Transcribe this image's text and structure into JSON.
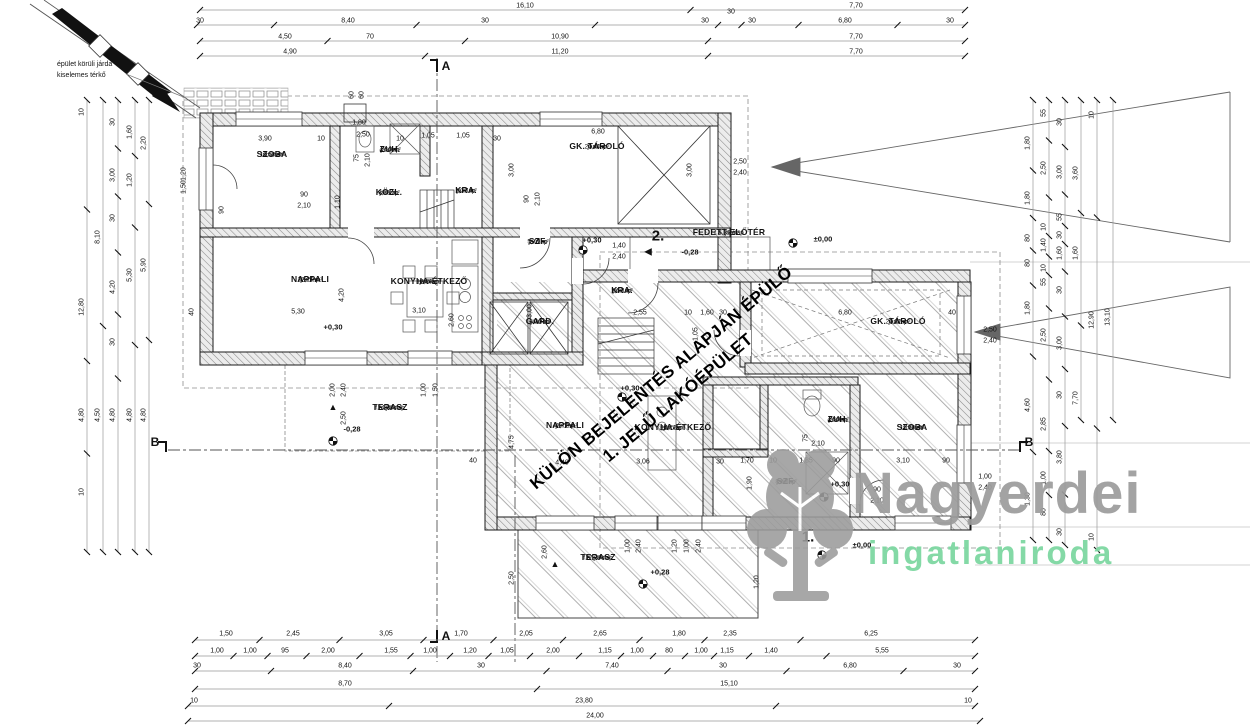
{
  "notes": {
    "line1": "épület körüli járda",
    "line2": "kiselemes térkő"
  },
  "watermark": {
    "line1": "KÜLÖN BEJELENTÉS ALAPJÁN ÉPÜLŐ",
    "line2": "1. JELŰ LAKÓÉPÜLET"
  },
  "logo": {
    "name": "Nagyerdei",
    "subtitle": "ingatlaniroda",
    "name_color": "#9c9c9c",
    "subtitle_color": "#7ed8a2",
    "tree_icon": "oak-tree-icon"
  },
  "colors": {
    "line": "#1a1a1a",
    "dim_text": "#111111",
    "hatch": "#9a9a9a",
    "chain_line": "#999999"
  },
  "section_marks": [
    {
      "t": "A",
      "x": 446,
      "y": 66
    },
    {
      "t": "A",
      "x": 446,
      "y": 636
    },
    {
      "t": "B",
      "x": 155,
      "y": 442
    },
    {
      "t": "B",
      "x": 1029,
      "y": 442
    }
  ],
  "building2": {
    "number": "2.",
    "nx": 658,
    "ny": 236,
    "rooms": [
      {
        "name": "SZOBA",
        "finish": "laminált",
        "area": "10,50 m²",
        "x": 272,
        "y": 155
      },
      {
        "name": "ZUH.",
        "finish": "járólap",
        "area": "4,50 m²",
        "x": 390,
        "y": 150
      },
      {
        "name": "KÖZL.",
        "finish": "járólap",
        "area": "3,88 m²",
        "x": 389,
        "y": 193
      },
      {
        "name": "KRA.",
        "finish": "járólap",
        "area": "1,37 m²",
        "x": 466,
        "y": 191
      },
      {
        "name": "GK. TÁROLÓ",
        "finish": "járólap",
        "area": "20,40 m²",
        "x": 597,
        "y": 147
      },
      {
        "name": "SZF.",
        "finish": "járólap",
        "area": "5,70 m²",
        "x": 538,
        "y": 242
      },
      {
        "name": "NAPPALI",
        "finish": "járólap",
        "area": "22,26 m²",
        "x": 310,
        "y": 280
      },
      {
        "name": "KONYHA-ÉTKEZŐ",
        "finish": "járólap",
        "area": "18,39 m²",
        "x": 429,
        "y": 282
      },
      {
        "name": "GARD.",
        "finish": "járólap",
        "area": "6,30 m²",
        "x": 540,
        "y": 322
      },
      {
        "name": "TERASZ",
        "finish": "f.á. járólap",
        "area": "14,88 m²",
        "x": 390,
        "y": 408
      },
      {
        "name": "FEDETT ELŐTÉR",
        "finish": "f.á. járólap",
        "area": "5,32 m²",
        "x": 729,
        "y": 233
      }
    ]
  },
  "building1": {
    "number": "1.",
    "nx": 808,
    "ny": 537,
    "rooms": [
      {
        "name": "KRA.",
        "finish": "járólap",
        "area": "2,52 m²",
        "x": 622,
        "y": 291
      },
      {
        "name": "GK. TÁROLÓ",
        "finish": "járólap",
        "area": "20,22 m²",
        "x": 898,
        "y": 322
      },
      {
        "name": "NAPPALI",
        "finish": "járólap",
        "area": "41,72 m²",
        "x": 565,
        "y": 426
      },
      {
        "name": "KONYHA-ÉTKEZŐ",
        "finish": "járólap",
        "area": "14,12 m²",
        "x": 673,
        "y": 428
      },
      {
        "name": "ZUH.",
        "finish": "járólap",
        "area": "4,50 m²",
        "x": 838,
        "y": 420
      },
      {
        "name": "SZOBA",
        "finish": "laminált",
        "area": "11,76 m²",
        "x": 912,
        "y": 428
      },
      {
        "name": "SZF.",
        "finish": "járólap",
        "area": "8,67 m²",
        "x": 786,
        "y": 482
      },
      {
        "name": "TERASZ",
        "finish": "f.á. járólap",
        "area": "17,39 m²",
        "x": 598,
        "y": 558
      }
    ]
  },
  "level_marks": [
    {
      "t": "±0,00",
      "x": 823,
      "y": 239
    },
    {
      "t": "+0,30",
      "x": 592,
      "y": 240
    },
    {
      "t": "-0,28",
      "x": 690,
      "y": 252
    },
    {
      "t": "+0,30",
      "x": 333,
      "y": 327
    },
    {
      "t": "-0,28",
      "x": 352,
      "y": 429
    },
    {
      "t": "+0,30",
      "x": 630,
      "y": 388
    },
    {
      "t": "+0,30",
      "x": 840,
      "y": 484
    },
    {
      "t": "+0,28",
      "x": 660,
      "y": 572
    },
    {
      "t": "±0,00",
      "x": 862,
      "y": 545
    }
  ],
  "benchmarks": [
    [
      583,
      250
    ],
    [
      793,
      243
    ],
    [
      333,
      441
    ],
    [
      622,
      397
    ],
    [
      824,
      497
    ],
    [
      643,
      584
    ],
    [
      822,
      555
    ]
  ],
  "markers": {
    "down_triangles": [
      [
        333,
        407
      ],
      [
        555,
        564
      ]
    ],
    "left_arrows": [
      [
        648,
        252
      ]
    ]
  },
  "dim_labels": [
    {
      "t": "16,10",
      "x": 525,
      "y": 6,
      "c": "t1"
    },
    {
      "t": "7,70",
      "x": 856,
      "y": 6,
      "c": "t1"
    },
    {
      "t": "30",
      "x": 200,
      "y": 21,
      "c": "t2"
    },
    {
      "t": "8,40",
      "x": 348,
      "y": 21,
      "c": "t2"
    },
    {
      "t": "30",
      "x": 485,
      "y": 21,
      "c": "t2"
    },
    {
      "t": "30",
      "x": 705,
      "y": 21,
      "c": "t2"
    },
    {
      "t": "30",
      "x": 731,
      "y": 12,
      "c": "t2"
    },
    {
      "t": "30",
      "x": 752,
      "y": 21,
      "c": "t2"
    },
    {
      "t": "6,80",
      "x": 845,
      "y": 21,
      "c": "t2"
    },
    {
      "t": "30",
      "x": 950,
      "y": 21,
      "c": "t2"
    },
    {
      "t": "4,50",
      "x": 285,
      "y": 37,
      "c": "t3"
    },
    {
      "t": "70",
      "x": 370,
      "y": 37,
      "c": "t3"
    },
    {
      "t": "10,90",
      "x": 560,
      "y": 37,
      "c": "t3"
    },
    {
      "t": "7,70",
      "x": 856,
      "y": 37,
      "c": "t3"
    },
    {
      "t": "4,90",
      "x": 290,
      "y": 52,
      "c": "t4"
    },
    {
      "t": "11,20",
      "x": 560,
      "y": 52,
      "c": "t4"
    },
    {
      "t": "7,70",
      "x": 856,
      "y": 52,
      "c": "t4"
    },
    {
      "t": "1,50",
      "x": 226,
      "y": 634,
      "c": "b1"
    },
    {
      "t": "2,45",
      "x": 293,
      "y": 634,
      "c": "b1"
    },
    {
      "t": "3,05",
      "x": 386,
      "y": 634,
      "c": "b1"
    },
    {
      "t": "1,70",
      "x": 461,
      "y": 634,
      "c": "b1"
    },
    {
      "t": "2,05",
      "x": 526,
      "y": 634,
      "c": "b1"
    },
    {
      "t": "2,65",
      "x": 600,
      "y": 634,
      "c": "b1"
    },
    {
      "t": "1,80",
      "x": 679,
      "y": 634,
      "c": "b1"
    },
    {
      "t": "2,35",
      "x": 730,
      "y": 634,
      "c": "b1"
    },
    {
      "t": "6,25",
      "x": 871,
      "y": 634,
      "c": "b1"
    },
    {
      "t": "1,00",
      "x": 217,
      "y": 651,
      "c": "b2"
    },
    {
      "t": "1,00",
      "x": 250,
      "y": 651,
      "c": "b2"
    },
    {
      "t": "95",
      "x": 285,
      "y": 651,
      "c": "b2"
    },
    {
      "t": "2,00",
      "x": 328,
      "y": 651,
      "c": "b2"
    },
    {
      "t": "1,55",
      "x": 391,
      "y": 651,
      "c": "b2"
    },
    {
      "t": "1,00",
      "x": 430,
      "y": 651,
      "c": "b2"
    },
    {
      "t": "1,20",
      "x": 470,
      "y": 651,
      "c": "b2"
    },
    {
      "t": "1,05",
      "x": 507,
      "y": 651,
      "c": "b2"
    },
    {
      "t": "2,00",
      "x": 553,
      "y": 651,
      "c": "b2"
    },
    {
      "t": "1,15",
      "x": 605,
      "y": 651,
      "c": "b2"
    },
    {
      "t": "1,00",
      "x": 637,
      "y": 651,
      "c": "b2"
    },
    {
      "t": "80",
      "x": 669,
      "y": 651,
      "c": "b2"
    },
    {
      "t": "1,00",
      "x": 701,
      "y": 651,
      "c": "b2"
    },
    {
      "t": "1,15",
      "x": 727,
      "y": 651,
      "c": "b2"
    },
    {
      "t": "1,40",
      "x": 771,
      "y": 651,
      "c": "b2"
    },
    {
      "t": "5,55",
      "x": 882,
      "y": 651,
      "c": "b2"
    },
    {
      "t": "30",
      "x": 197,
      "y": 666,
      "c": "b3"
    },
    {
      "t": "8,40",
      "x": 345,
      "y": 666,
      "c": "b3"
    },
    {
      "t": "30",
      "x": 481,
      "y": 666,
      "c": "b3"
    },
    {
      "t": "7,40",
      "x": 612,
      "y": 666,
      "c": "b3"
    },
    {
      "t": "30",
      "x": 723,
      "y": 666,
      "c": "b3"
    },
    {
      "t": "6,80",
      "x": 850,
      "y": 666,
      "c": "b3"
    },
    {
      "t": "30",
      "x": 957,
      "y": 666,
      "c": "b3"
    },
    {
      "t": "8,70",
      "x": 345,
      "y": 684,
      "c": "b4"
    },
    {
      "t": "15,10",
      "x": 729,
      "y": 684,
      "c": "b4"
    },
    {
      "t": "10",
      "x": 194,
      "y": 701,
      "c": "b5"
    },
    {
      "t": "23,80",
      "x": 584,
      "y": 701,
      "c": "b5"
    },
    {
      "t": "10",
      "x": 968,
      "y": 701,
      "c": "b5"
    },
    {
      "t": "24,00",
      "x": 595,
      "y": 716,
      "c": "b6"
    },
    {
      "t": "10",
      "x": 82,
      "y": 112,
      "r": 1,
      "c": "l1"
    },
    {
      "t": "12,80",
      "x": 82,
      "y": 307,
      "r": 1,
      "c": "l1"
    },
    {
      "t": "4,80",
      "x": 82,
      "y": 415,
      "r": 1,
      "c": "l1"
    },
    {
      "t": "10",
      "x": 82,
      "y": 492,
      "r": 1,
      "c": "l1"
    },
    {
      "t": "8,10",
      "x": 98,
      "y": 237,
      "r": 1,
      "c": "l2"
    },
    {
      "t": "4,50",
      "x": 98,
      "y": 415,
      "r": 1,
      "c": "l2"
    },
    {
      "t": "30",
      "x": 113,
      "y": 122,
      "r": 1,
      "c": "l3"
    },
    {
      "t": "3,00",
      "x": 113,
      "y": 175,
      "r": 1,
      "c": "l3"
    },
    {
      "t": "30",
      "x": 113,
      "y": 218,
      "r": 1,
      "c": "l3"
    },
    {
      "t": "4,20",
      "x": 113,
      "y": 287,
      "r": 1,
      "c": "l3"
    },
    {
      "t": "30",
      "x": 113,
      "y": 342,
      "r": 1,
      "c": "l3"
    },
    {
      "t": "4,80",
      "x": 113,
      "y": 415,
      "r": 1,
      "c": "l3"
    },
    {
      "t": "1,60",
      "x": 130,
      "y": 132,
      "r": 1,
      "c": "l4"
    },
    {
      "t": "1,20",
      "x": 130,
      "y": 180,
      "r": 1,
      "c": "l4"
    },
    {
      "t": "5,30",
      "x": 130,
      "y": 275,
      "r": 1,
      "c": "l4"
    },
    {
      "t": "4,80",
      "x": 130,
      "y": 415,
      "r": 1,
      "c": "l4"
    },
    {
      "t": "2,20",
      "x": 144,
      "y": 143,
      "r": 1,
      "c": "l5"
    },
    {
      "t": "5,90",
      "x": 144,
      "y": 265,
      "r": 1,
      "c": "l5"
    },
    {
      "t": "4,80",
      "x": 144,
      "y": 415,
      "r": 1,
      "c": "l5"
    },
    {
      "t": "1,80",
      "x": 1028,
      "y": 143,
      "r": 1,
      "c": "r1"
    },
    {
      "t": "1,80",
      "x": 1028,
      "y": 198,
      "r": 1,
      "c": "r1"
    },
    {
      "t": "80",
      "x": 1028,
      "y": 238,
      "r": 1,
      "c": "r1"
    },
    {
      "t": "80",
      "x": 1028,
      "y": 263,
      "r": 1,
      "c": "r1"
    },
    {
      "t": "1,80",
      "x": 1028,
      "y": 308,
      "r": 1,
      "c": "r1"
    },
    {
      "t": "4,60",
      "x": 1028,
      "y": 405,
      "r": 1,
      "c": "r1"
    },
    {
      "t": "1,30",
      "x": 1028,
      "y": 499,
      "r": 1,
      "c": "r1"
    },
    {
      "t": "55",
      "x": 1044,
      "y": 113,
      "r": 1,
      "c": "r2"
    },
    {
      "t": "2,50",
      "x": 1044,
      "y": 168,
      "r": 1,
      "c": "r2"
    },
    {
      "t": "10",
      "x": 1044,
      "y": 227,
      "r": 1,
      "c": "r2"
    },
    {
      "t": "1,40",
      "x": 1044,
      "y": 245,
      "r": 1,
      "c": "r2"
    },
    {
      "t": "10",
      "x": 1044,
      "y": 268,
      "r": 1,
      "c": "r2"
    },
    {
      "t": "55",
      "x": 1044,
      "y": 282,
      "r": 1,
      "c": "r2"
    },
    {
      "t": "2,50",
      "x": 1044,
      "y": 335,
      "r": 1,
      "c": "r2"
    },
    {
      "t": "2,85",
      "x": 1044,
      "y": 424,
      "r": 1,
      "c": "r2"
    },
    {
      "t": "1,00",
      "x": 1044,
      "y": 478,
      "r": 1,
      "c": "r2"
    },
    {
      "t": "80",
      "x": 1044,
      "y": 512,
      "r": 1,
      "c": "r2"
    },
    {
      "t": "30",
      "x": 1060,
      "y": 122,
      "r": 1,
      "c": "r3"
    },
    {
      "t": "3,00",
      "x": 1060,
      "y": 172,
      "r": 1,
      "c": "r3"
    },
    {
      "t": "55",
      "x": 1060,
      "y": 217,
      "r": 1,
      "c": "r3"
    },
    {
      "t": "30",
      "x": 1060,
      "y": 235,
      "r": 1,
      "c": "r3"
    },
    {
      "t": "1,60",
      "x": 1060,
      "y": 253,
      "r": 1,
      "c": "r3"
    },
    {
      "t": "30",
      "x": 1060,
      "y": 290,
      "r": 1,
      "c": "r3"
    },
    {
      "t": "3,00",
      "x": 1060,
      "y": 343,
      "r": 1,
      "c": "r3"
    },
    {
      "t": "30",
      "x": 1060,
      "y": 395,
      "r": 1,
      "c": "r3"
    },
    {
      "t": "3,80",
      "x": 1060,
      "y": 457,
      "r": 1,
      "c": "r3"
    },
    {
      "t": "30",
      "x": 1060,
      "y": 532,
      "r": 1,
      "c": "r3"
    },
    {
      "t": "3,60",
      "x": 1076,
      "y": 173,
      "r": 1,
      "c": "r4"
    },
    {
      "t": "1,60",
      "x": 1076,
      "y": 253,
      "r": 1,
      "c": "r4"
    },
    {
      "t": "7,70",
      "x": 1076,
      "y": 398,
      "r": 1,
      "c": "r4"
    },
    {
      "t": "10",
      "x": 1092,
      "y": 115,
      "r": 1,
      "c": "r5"
    },
    {
      "t": "12,90",
      "x": 1092,
      "y": 320,
      "r": 1,
      "c": "r5"
    },
    {
      "t": "10",
      "x": 1092,
      "y": 537,
      "r": 1,
      "c": "r5"
    },
    {
      "t": "13,10",
      "x": 1108,
      "y": 317,
      "r": 1,
      "c": "r6"
    },
    {
      "t": "3,90",
      "x": 265,
      "y": 139
    },
    {
      "t": "10",
      "x": 321,
      "y": 139
    },
    {
      "t": "2,50",
      "x": 363,
      "y": 135
    },
    {
      "t": "10",
      "x": 400,
      "y": 139
    },
    {
      "t": "1,05",
      "x": 428,
      "y": 136
    },
    {
      "t": "1,05",
      "x": 463,
      "y": 136
    },
    {
      "t": "30",
      "x": 497,
      "y": 139
    },
    {
      "t": "1,80",
      "x": 359,
      "y": 123
    },
    {
      "t": "6,80",
      "x": 598,
      "y": 132
    },
    {
      "t": "3,00",
      "x": 512,
      "y": 170,
      "r": 1
    },
    {
      "t": "3,00",
      "x": 690,
      "y": 170,
      "r": 1
    },
    {
      "t": "2,50",
      "x": 740,
      "y": 162
    },
    {
      "t": "2,40",
      "x": 740,
      "y": 173
    },
    {
      "t": "90",
      "x": 304,
      "y": 195
    },
    {
      "t": "2,10",
      "x": 304,
      "y": 206
    },
    {
      "t": "90",
      "x": 527,
      "y": 199,
      "r": 1
    },
    {
      "t": "2,10",
      "x": 538,
      "y": 199,
      "r": 1
    },
    {
      "t": "75",
      "x": 357,
      "y": 158,
      "r": 1
    },
    {
      "t": "2,10",
      "x": 368,
      "y": 160,
      "r": 1
    },
    {
      "t": "1,10",
      "x": 338,
      "y": 202,
      "r": 1
    },
    {
      "t": "90",
      "x": 222,
      "y": 210,
      "r": 1
    },
    {
      "t": "5,30",
      "x": 298,
      "y": 312
    },
    {
      "t": "4,20",
      "x": 342,
      "y": 295,
      "r": 1
    },
    {
      "t": "40",
      "x": 192,
      "y": 312,
      "r": 1
    },
    {
      "t": "3,10",
      "x": 419,
      "y": 311
    },
    {
      "t": "2,60",
      "x": 452,
      "y": 320,
      "r": 1
    },
    {
      "t": "3,00",
      "x": 530,
      "y": 311,
      "r": 1
    },
    {
      "t": "2,00",
      "x": 333,
      "y": 390,
      "r": 1
    },
    {
      "t": "2,40",
      "x": 344,
      "y": 390,
      "r": 1
    },
    {
      "t": "1,00",
      "x": 424,
      "y": 390,
      "r": 1
    },
    {
      "t": "1,50",
      "x": 436,
      "y": 390,
      "r": 1
    },
    {
      "t": "2,50",
      "x": 344,
      "y": 418,
      "r": 1
    },
    {
      "t": "1,40",
      "x": 619,
      "y": 246
    },
    {
      "t": "2,40",
      "x": 619,
      "y": 257
    },
    {
      "t": "2,55",
      "x": 640,
      "y": 313
    },
    {
      "t": "10",
      "x": 688,
      "y": 313
    },
    {
      "t": "1,60",
      "x": 707,
      "y": 313
    },
    {
      "t": "30",
      "x": 723,
      "y": 313
    },
    {
      "t": "1,05",
      "x": 696,
      "y": 334,
      "r": 1
    },
    {
      "t": "6,80",
      "x": 845,
      "y": 313
    },
    {
      "t": "40",
      "x": 952,
      "y": 313
    },
    {
      "t": "2,50",
      "x": 990,
      "y": 330
    },
    {
      "t": "2,40",
      "x": 990,
      "y": 341
    },
    {
      "t": "40",
      "x": 473,
      "y": 461
    },
    {
      "t": "4,40",
      "x": 562,
      "y": 463
    },
    {
      "t": "3,06",
      "x": 643,
      "y": 462
    },
    {
      "t": "30",
      "x": 720,
      "y": 462
    },
    {
      "t": "1,70",
      "x": 747,
      "y": 461
    },
    {
      "t": "10",
      "x": 773,
      "y": 461
    },
    {
      "t": "1,85",
      "x": 806,
      "y": 461
    },
    {
      "t": "90",
      "x": 836,
      "y": 461
    },
    {
      "t": "3,10",
      "x": 903,
      "y": 461
    },
    {
      "t": "90",
      "x": 946,
      "y": 461
    },
    {
      "t": "4,75",
      "x": 512,
      "y": 442,
      "r": 1
    },
    {
      "t": "1,90",
      "x": 750,
      "y": 483,
      "r": 1
    },
    {
      "t": "2,10",
      "x": 818,
      "y": 444
    },
    {
      "t": "75",
      "x": 806,
      "y": 438,
      "r": 1
    },
    {
      "t": "90",
      "x": 877,
      "y": 490
    },
    {
      "t": "2,10",
      "x": 877,
      "y": 501
    },
    {
      "t": "1,00",
      "x": 628,
      "y": 546,
      "r": 1
    },
    {
      "t": "2,40",
      "x": 639,
      "y": 546,
      "r": 1
    },
    {
      "t": "1,20",
      "x": 675,
      "y": 546,
      "r": 1
    },
    {
      "t": "1,00",
      "x": 687,
      "y": 546,
      "r": 1
    },
    {
      "t": "2,40",
      "x": 699,
      "y": 546,
      "r": 1
    },
    {
      "t": "2,60",
      "x": 545,
      "y": 552,
      "r": 1
    },
    {
      "t": "2,50",
      "x": 512,
      "y": 578,
      "r": 1
    },
    {
      "t": "1,20",
      "x": 757,
      "y": 582,
      "r": 1
    },
    {
      "t": "1,00",
      "x": 985,
      "y": 477
    },
    {
      "t": "2,40",
      "x": 985,
      "y": 488
    },
    {
      "t": "60",
      "x": 352,
      "y": 95,
      "r": 1
    },
    {
      "t": "60",
      "x": 362,
      "y": 95,
      "r": 1
    },
    {
      "t": "1,20",
      "x": 184,
      "y": 174,
      "r": 1
    },
    {
      "t": "1,50",
      "x": 184,
      "y": 187,
      "r": 1
    }
  ]
}
